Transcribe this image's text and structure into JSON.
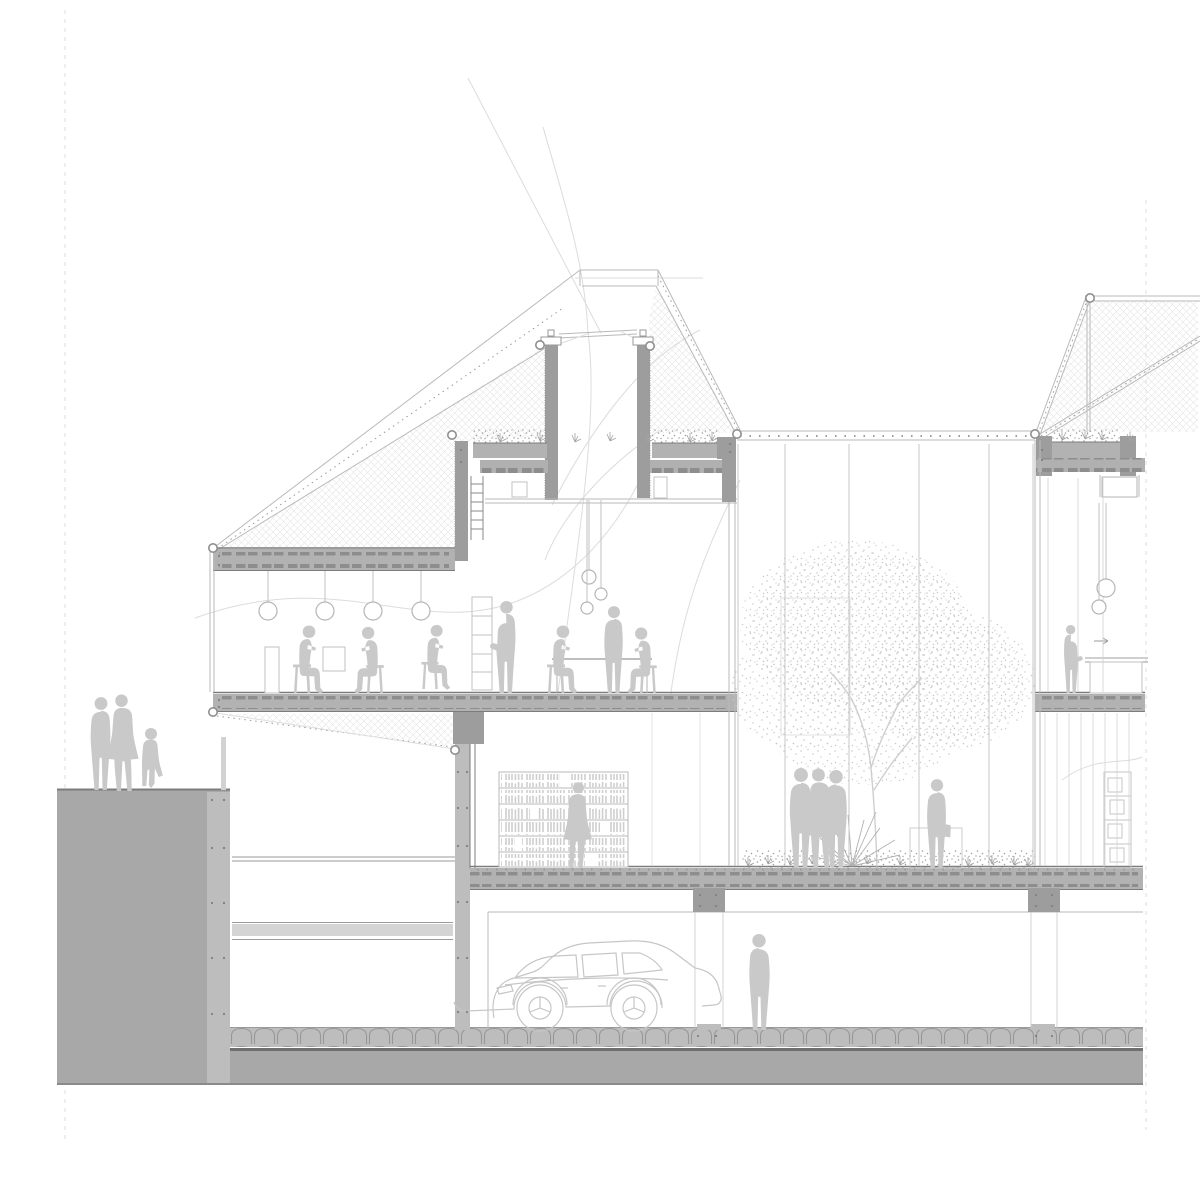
{
  "title": "Architectural cross-section drawing of a multi-storey building",
  "description": "Grey-scale section: plaza with pedestrians at left, two-level building with cafe floor and library, glazed courtyard with tree, second block with bar counter at right, underground parking with car, hatched roof trusses above.",
  "colors": {
    "paper": "#ffffff",
    "cut": "#a8a8a8",
    "cutLight": "#bdbdbd",
    "wall": "#9d9d9d",
    "slab": "#b2b2b2",
    "slabEdge": "#7c7c7c",
    "ribs": "#8d8d8d",
    "line": "#b9b9b9",
    "lineFaint": "#dedede",
    "lineMid": "#9a9a9a",
    "figure": "#c9c9c9",
    "hatch": "#e5e5e5",
    "stipple": "#c9c9c9",
    "ground_dark": "#6f6f6f"
  },
  "figures": [
    {
      "name": "plaza-adult",
      "pose": "stand",
      "x": 101,
      "y": 790,
      "s": 0.92,
      "flip": false
    },
    {
      "name": "plaza-adult-coat",
      "pose": "woman",
      "x": 122,
      "y": 791,
      "s": 0.99,
      "flip": true
    },
    {
      "name": "plaza-child",
      "pose": "child",
      "x": 151,
      "y": 790,
      "s": 1,
      "flip": false
    },
    {
      "name": "cafe-seated-1",
      "pose": "sit",
      "x": 302,
      "y": 693,
      "s": 1,
      "flip": true,
      "stool": true
    },
    {
      "name": "cafe-seated-2",
      "pose": "sit",
      "x": 375,
      "y": 693,
      "s": 0.98,
      "flip": false,
      "stool": true
    },
    {
      "name": "cafe-seated-3",
      "pose": "sit",
      "x": 430,
      "y": 689,
      "s": 0.95,
      "flip": true,
      "stool": true
    },
    {
      "name": "cafe-standing-cup",
      "pose": "standcup",
      "x": 506,
      "y": 693,
      "s": 0.92,
      "flip": false
    },
    {
      "name": "cafe-table-guest-left",
      "pose": "sit",
      "x": 556,
      "y": 693,
      "s": 1,
      "flip": true,
      "stool": true
    },
    {
      "name": "cafe-standing",
      "pose": "stand",
      "x": 614,
      "y": 693,
      "s": 0.86,
      "flip": false
    },
    {
      "name": "cafe-table-guest-right",
      "pose": "sit",
      "x": 648,
      "y": 693,
      "s": 0.97,
      "flip": false,
      "stool": true
    },
    {
      "name": "library-walker",
      "pose": "woman",
      "x": 578,
      "y": 868,
      "s": 0.88,
      "flip": false
    },
    {
      "name": "courtyard-group-1",
      "pose": "stand",
      "x": 801,
      "y": 868,
      "s": 0.99,
      "flip": false
    },
    {
      "name": "courtyard-group-2",
      "pose": "woman",
      "x": 819,
      "y": 868,
      "s": 1.02,
      "flip": true
    },
    {
      "name": "courtyard-group-3",
      "pose": "stand",
      "x": 836,
      "y": 867,
      "s": 0.96,
      "flip": true
    },
    {
      "name": "courtyard-visitor",
      "pose": "standbag",
      "x": 937,
      "y": 868,
      "s": 0.88,
      "flip": false
    },
    {
      "name": "bar-attendant",
      "pose": "standcup",
      "x": 1071,
      "y": 693,
      "s": 0.68,
      "flip": true
    },
    {
      "name": "garage-visitor",
      "pose": "stand",
      "x": 759,
      "y": 1030,
      "s": 0.95,
      "flip": true
    }
  ],
  "lamps": [
    {
      "x": 268,
      "top": 571,
      "y": 611,
      "r": 9
    },
    {
      "x": 325,
      "top": 571,
      "y": 611,
      "r": 9
    },
    {
      "x": 373,
      "top": 571,
      "y": 611,
      "r": 9
    },
    {
      "x": 421,
      "top": 571,
      "y": 611,
      "r": 9
    },
    {
      "x": 589,
      "top": 500,
      "y": 577,
      "r": 7
    },
    {
      "x": 601,
      "top": 500,
      "y": 594,
      "r": 6
    },
    {
      "x": 587,
      "top": 500,
      "y": 608,
      "r": 6
    },
    {
      "x": 1106,
      "top": 503,
      "y": 588,
      "r": 9
    },
    {
      "x": 1099,
      "top": 503,
      "y": 607,
      "r": 7
    }
  ],
  "nodes": [
    [
      213,
      548
    ],
    [
      213,
      712
    ],
    [
      455,
      750
    ],
    [
      452,
      435
    ],
    [
      540,
      345
    ],
    [
      650,
      346
    ],
    [
      737,
      434
    ],
    [
      1035,
      434
    ],
    [
      1090,
      298
    ]
  ],
  "mullions": [
    {
      "name": "courtyard-mullion",
      "xs": [
        738,
        785,
        849,
        919,
        989,
        1033
      ],
      "y1": 444,
      "y2": 866,
      "w": 1,
      "color": "#c7c7c7"
    },
    {
      "name": "right-ground-mullion",
      "xs": [
        1045,
        1057,
        1069,
        1081,
        1093,
        1105,
        1117,
        1129
      ],
      "y1": 713,
      "y2": 866,
      "w": 0.8,
      "color": "#d4d4d4"
    },
    {
      "name": "right-upper-mullion",
      "xs": [
        1048,
        1078,
        1103
      ],
      "y1": 478,
      "y2": 692,
      "w": 0.8,
      "color": "#d0d0d0"
    },
    {
      "name": "library-partition",
      "xs": [
        652,
        700
      ],
      "y1": 713,
      "y2": 866,
      "w": 0.8,
      "color": "#dcdcdc"
    },
    {
      "name": "garage-column-line",
      "xs": [
        695,
        723,
        1031,
        1057
      ],
      "y1": 912,
      "y2": 1028,
      "w": 0.8,
      "color": "#c9c9c9"
    }
  ],
  "sprigs": [
    [
      500,
      442
    ],
    [
      540,
      441
    ],
    [
      575,
      442
    ],
    [
      610,
      441
    ],
    [
      648,
      442
    ],
    [
      690,
      442
    ],
    [
      712,
      441
    ],
    [
      1062,
      440
    ],
    [
      1085,
      439
    ],
    [
      1102,
      440
    ],
    [
      1130,
      441
    ],
    [
      748,
      866
    ],
    [
      768,
      864
    ],
    [
      790,
      865
    ],
    [
      812,
      864
    ],
    [
      833,
      866
    ],
    [
      867,
      864
    ],
    [
      900,
      865
    ],
    [
      968,
      866
    ],
    [
      992,
      864
    ],
    [
      1014,
      865
    ],
    [
      1028,
      866
    ]
  ],
  "wall_dots": [
    [
      212,
      800
    ],
    [
      224,
      800
    ],
    [
      212,
      848
    ],
    [
      224,
      848
    ],
    [
      212,
      903
    ],
    [
      224,
      903
    ],
    [
      212,
      958
    ],
    [
      224,
      958
    ],
    [
      212,
      1014
    ],
    [
      224,
      1014
    ],
    [
      458,
      772
    ],
    [
      467,
      772
    ],
    [
      458,
      808
    ],
    [
      467,
      808
    ],
    [
      458,
      846
    ],
    [
      467,
      846
    ],
    [
      458,
      902
    ],
    [
      467,
      902
    ],
    [
      458,
      958
    ],
    [
      467,
      958
    ],
    [
      458,
      1012
    ],
    [
      467,
      1012
    ],
    [
      700,
      895
    ],
    [
      716,
      895
    ],
    [
      700,
      906
    ],
    [
      716,
      906
    ],
    [
      1036,
      895
    ],
    [
      1052,
      895
    ],
    [
      1036,
      906
    ],
    [
      1052,
      906
    ],
    [
      698,
      1036
    ],
    [
      716,
      1036
    ],
    [
      1036,
      1036
    ],
    [
      1052,
      1036
    ],
    [
      219,
      556
    ],
    [
      219,
      565
    ],
    [
      219,
      700
    ],
    [
      219,
      707
    ],
    [
      461,
      450
    ],
    [
      461,
      462
    ],
    [
      730,
      444
    ],
    [
      730,
      452
    ],
    [
      1042,
      450
    ],
    [
      1042,
      460
    ]
  ]
}
